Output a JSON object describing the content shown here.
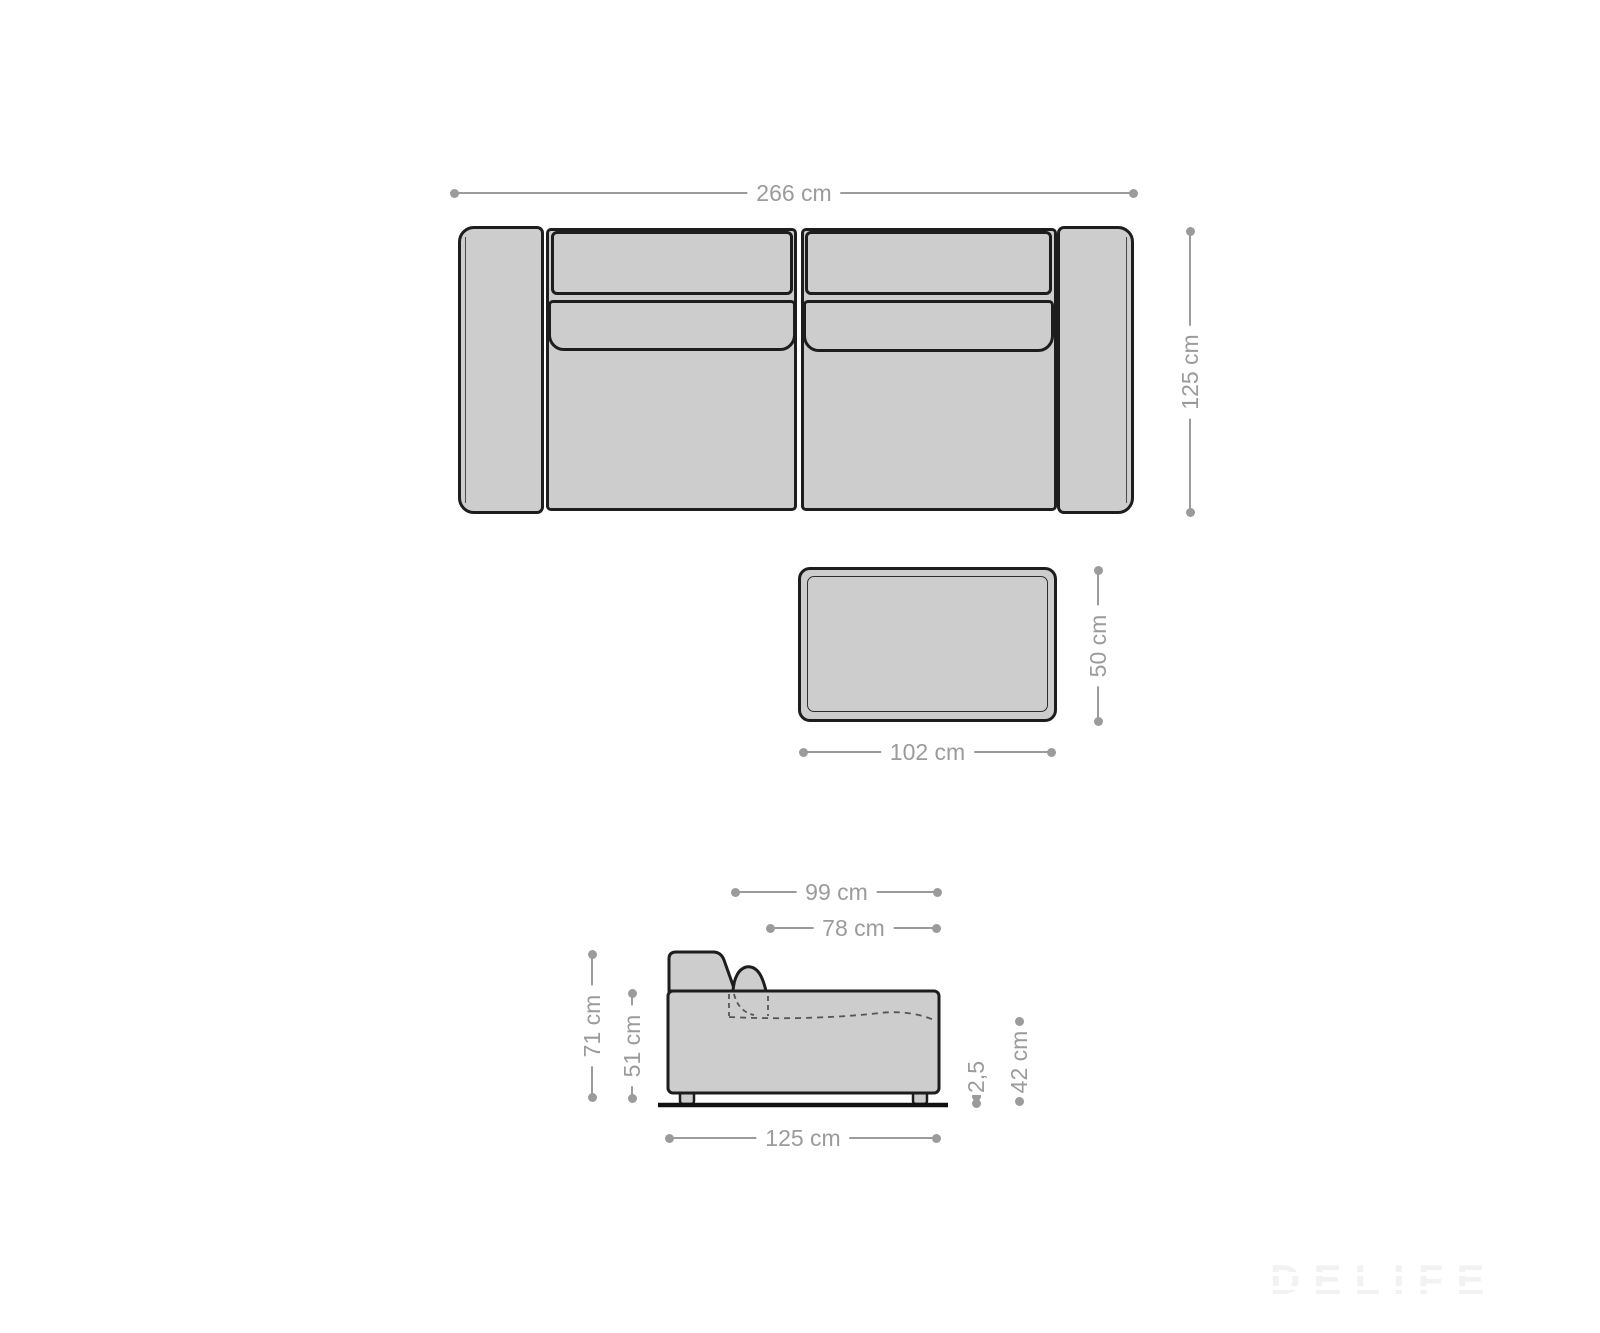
{
  "page": {
    "type": "furniture-dimension-diagram",
    "background": "#ffffff"
  },
  "colors": {
    "furniture_fill": "#cdcdcd",
    "furniture_outline": "#1d1d1d",
    "dimension_gray": "#9b9b9b",
    "watermark_gray": "#f2f2f2"
  },
  "views": {
    "sofa_top_view": "top view of 3-seater sofa with two armrests, two back cushions, two seat cushions",
    "stool_top_view": "top view of rectangular stool / ottoman",
    "sofa_side_view": "side profile of sofa with backrest, pillow (hidden part dashed), feet and ground line"
  },
  "dims": {
    "sofa_top_width": {
      "label": "266 cm"
    },
    "sofa_top_depth": {
      "label": "125 cm"
    },
    "stool_width": {
      "label": "102 cm"
    },
    "stool_depth": {
      "label": "50 cm"
    },
    "side_depth_total": {
      "label": "99 cm"
    },
    "side_seat_depth": {
      "label": "78 cm"
    },
    "side_height_total": {
      "label": "71 cm"
    },
    "side_height_body": {
      "label": "51 cm"
    },
    "side_length": {
      "label": "125 cm"
    },
    "side_foot_height": {
      "label": "2,5"
    },
    "side_seat_height": {
      "label": "42 cm"
    }
  },
  "watermark": {
    "label": "DELIFE"
  }
}
